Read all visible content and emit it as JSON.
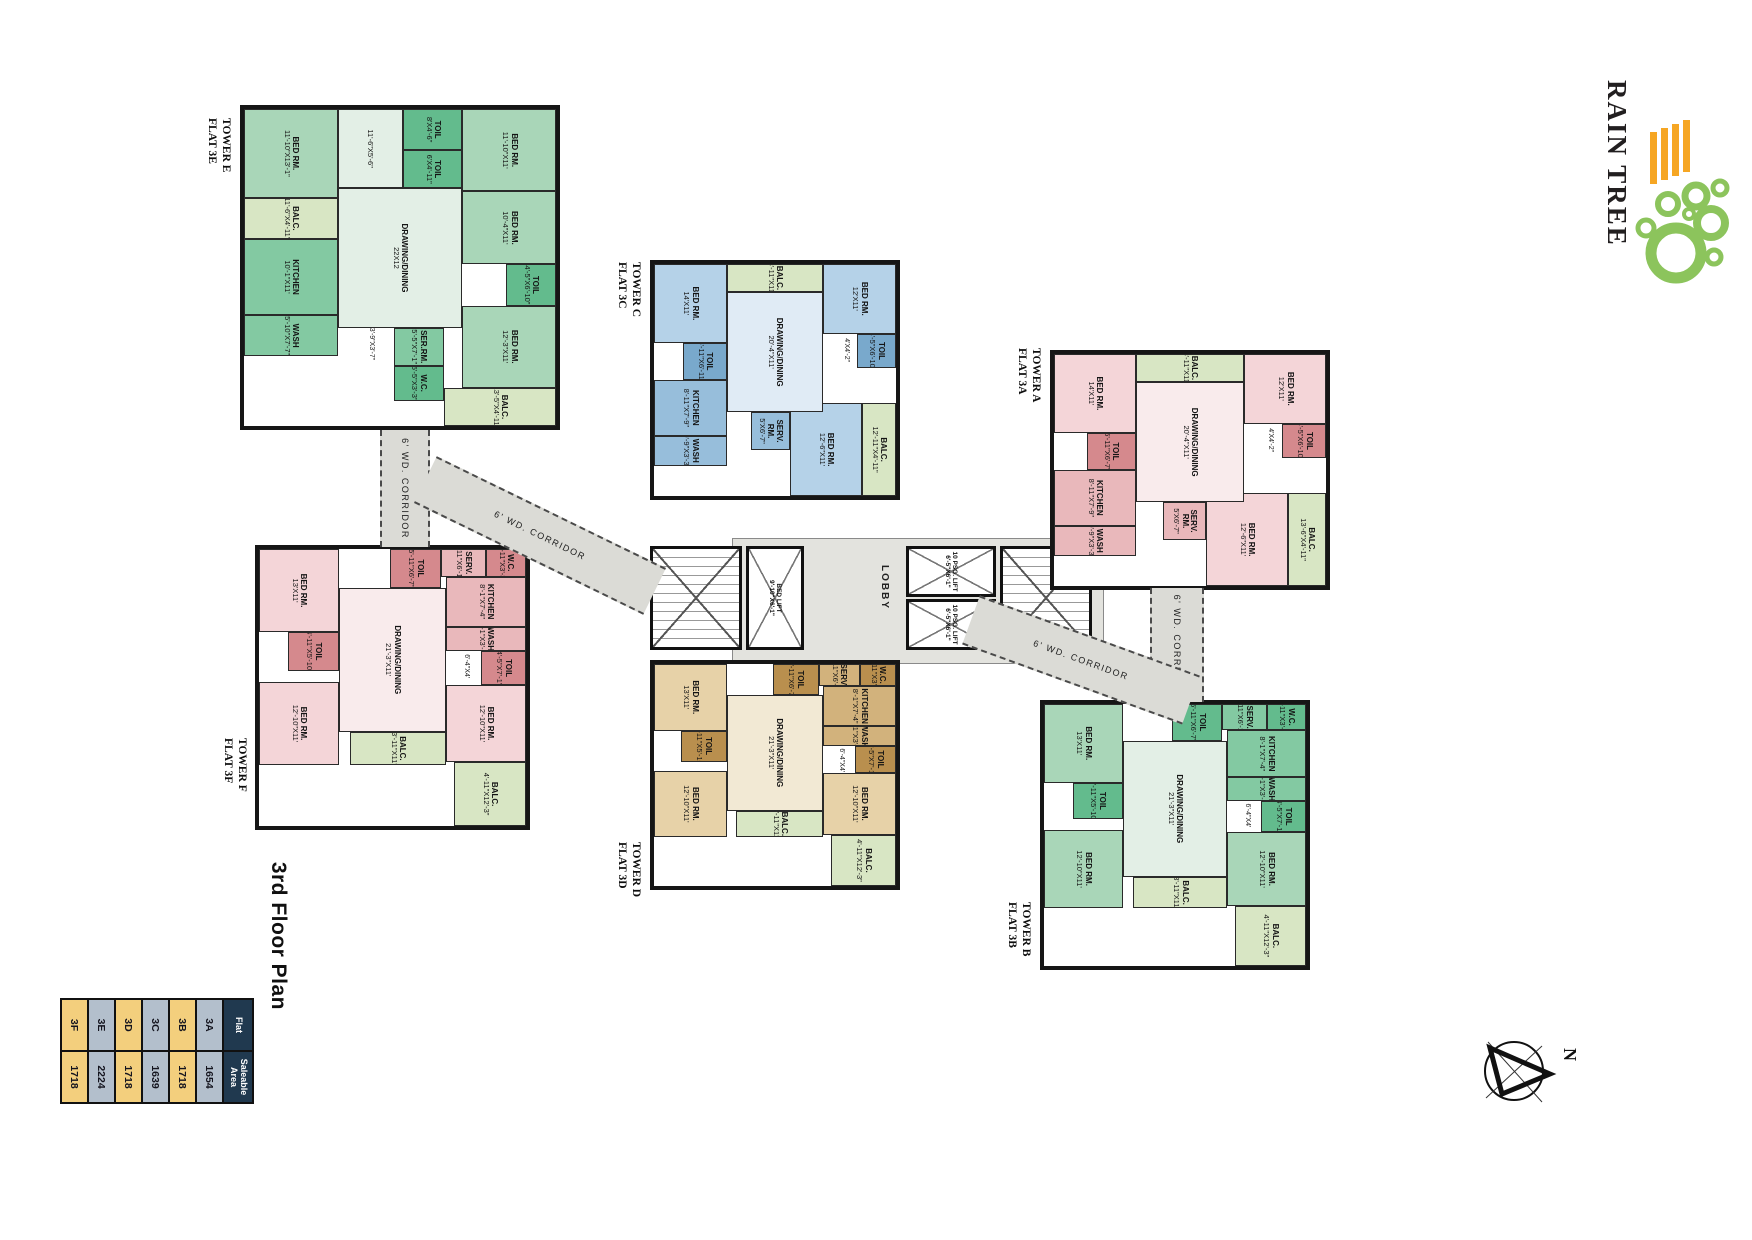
{
  "logo": {
    "name": "RAIN TREE",
    "tree_color": "#8cc45c",
    "ray_color": "#f6a623",
    "text_color": "#221f20"
  },
  "plan_title": "3rd Floor Plan",
  "compass_label": "N",
  "corridor_label": "6' WD. CORRIDOR",
  "core": {
    "lobby": "LOBBY",
    "psg_lift": "10 PSG. LIFT",
    "psg_lift_dim": "6'-5\"X6'-1\"",
    "bed_lift": "BED LIFT",
    "bed_lift_dim": "9'-10\"X6'-1\""
  },
  "area_table": {
    "headers": [
      "Flat",
      "Saleable Area"
    ],
    "rows": [
      {
        "flat": "3A",
        "area": "1654"
      },
      {
        "flat": "3B",
        "area": "1718"
      },
      {
        "flat": "3C",
        "area": "1639"
      },
      {
        "flat": "3D",
        "area": "1718"
      },
      {
        "flat": "3E",
        "area": "2224"
      },
      {
        "flat": "3F",
        "area": "1718"
      }
    ]
  },
  "towers": [
    {
      "id": "E",
      "tower_label": "TOWER E",
      "flat_label": "FLAT 3E",
      "palette": {
        "room": "#a9d6b8",
        "deep": "#63bb8d",
        "mid": "#83c9a2",
        "hall": "#e3efe6",
        "balc": "#d8e6c4"
      },
      "passages": [
        "3'-9\"X3'-7\"",
        "3'-4\"X5'-1\"",
        "4'-5\"X4'-2\"",
        "5'-10\"X5'-1\""
      ],
      "rooms": [
        {
          "name": "BED RM.",
          "dim": "11'-10\"X11'"
        },
        {
          "name": "BED RM.",
          "dim": "10'-4\"X11'"
        },
        {
          "name": "TOIL",
          "dim": "4'-5\"X6'-10\""
        },
        {
          "name": "BED RM.",
          "dim": "12'-3\"X11'"
        },
        {
          "name": "BALC.",
          "dim": "13'-5\"X4'-11\""
        },
        {
          "name": "TOIL",
          "dim": "8'X4'-6\""
        },
        {
          "name": "TOIL",
          "dim": "6'X4'-11\""
        },
        {
          "name": "",
          "dim": "11'-6\"X5'-6\""
        },
        {
          "name": "DRAWING/DINING",
          "dim": "22X12"
        },
        {
          "name": "SER.RM.",
          "dim": "5'-5\"X7'-1\""
        },
        {
          "name": "W.C.",
          "dim": "5'-5\"X3'-3\""
        },
        {
          "name": "BED RM.",
          "dim": "11'-10\"X13'-1\""
        },
        {
          "name": "BALC.",
          "dim": "11'-6\"X4'-11\""
        },
        {
          "name": "KITCHEN",
          "dim": "10'-1\"X11'"
        },
        {
          "name": "WASH",
          "dim": "5'-10\"X7'-7\""
        }
      ]
    },
    {
      "id": "C",
      "tower_label": "TOWER C",
      "flat_label": "FLAT 3C",
      "palette": {
        "room": "#b5d2e8",
        "deep": "#79a9cc",
        "mid": "#97bedb",
        "hall": "#e0ebf5",
        "balc": "#d8e6c4"
      },
      "passages": [
        "4'X4'-2\"",
        "5'-5\"X4'"
      ],
      "rooms": [
        {
          "name": "BED RM.",
          "dim": "12'X11'"
        },
        {
          "name": "TOIL",
          "dim": "4'-5\"X6'-10\""
        },
        {
          "name": "BED RM.",
          "dim": "12'-6\"X11'"
        },
        {
          "name": "BALC.",
          "dim": "12'-11\"X4'-11\""
        },
        {
          "name": "BALC.",
          "dim": "3'-11\"X11'"
        },
        {
          "name": "DRAWING/DINING",
          "dim": "20'-4\"X11'"
        },
        {
          "name": "SERV. RM.",
          "dim": "5'X6'-7\""
        },
        {
          "name": "BED RM.",
          "dim": "14'X11'"
        },
        {
          "name": "TOIL",
          "dim": "5'-11\"X6'-11\""
        },
        {
          "name": "KITCHEN",
          "dim": "8'-11\"X7'-9\""
        },
        {
          "name": "WASH",
          "dim": "9'-9\"X3'-3\""
        }
      ]
    },
    {
      "id": "A",
      "tower_label": "TOWER A",
      "flat_label": "FLAT 3A",
      "palette": {
        "room": "#f4d5d8",
        "deep": "#d5898d",
        "mid": "#e9b8bb",
        "hall": "#f9ebec",
        "balc": "#d8e6c4"
      },
      "passages": [
        "4'X4'-2\"",
        "5'-5\"X4'"
      ],
      "rooms": [
        {
          "name": "BED RM.",
          "dim": "12'X11'"
        },
        {
          "name": "TOIL",
          "dim": "4'-5\"X6'-10\""
        },
        {
          "name": "BED RM.",
          "dim": "12'-6\"X11'"
        },
        {
          "name": "BALC.",
          "dim": "13'-6\"X4'-11\""
        },
        {
          "name": "BALC.",
          "dim": "3'-11\"X11'"
        },
        {
          "name": "DRAWING/DINING",
          "dim": "20'-4\"X11'"
        },
        {
          "name": "SERV. RM.",
          "dim": "5'X6'-7\""
        },
        {
          "name": "BED RM.",
          "dim": "14'X11'"
        },
        {
          "name": "TOIL",
          "dim": "5'-11\"X6'-7\""
        },
        {
          "name": "KITCHEN",
          "dim": "8'-11\"X7'-9\""
        },
        {
          "name": "WASH",
          "dim": "9'-9\"X3'-3\""
        }
      ]
    },
    {
      "id": "F",
      "tower_label": "TOWER F",
      "flat_label": "FLAT 3F",
      "palette": {
        "room": "#f4d5d8",
        "deep": "#d5898d",
        "mid": "#e9b8bb",
        "hall": "#f9ebec",
        "balc": "#d8e6c4"
      },
      "passages": [
        "6'-4\"X4'",
        "4'-11\"X4'-2\"",
        "4'-10\"X3'-6\""
      ],
      "rooms": [
        {
          "name": "W.C.",
          "dim": "4'-11\"X3'-3\""
        },
        {
          "name": "SERV.",
          "dim": "4'-11\"X6'-11\""
        },
        {
          "name": "KITCHEN",
          "dim": "8'-1\"X7'-4\""
        },
        {
          "name": "WASH",
          "dim": "8'-1\"X3'-8\""
        },
        {
          "name": "TOIL",
          "dim": "4'-5\"X7'-1\""
        },
        {
          "name": "BED RM.",
          "dim": "12'-10\"X11'"
        },
        {
          "name": "BALC.",
          "dim": "4'-11\"X12'-3\""
        },
        {
          "name": "TOIL",
          "dim": "5'-11\"X6'-7\""
        },
        {
          "name": "DRAWING/DINING",
          "dim": "21'-3\"X11'"
        },
        {
          "name": "BALC.",
          "dim": "3'-11\"X11'"
        },
        {
          "name": "BED RM.",
          "dim": "13'X11'"
        },
        {
          "name": "TOIL",
          "dim": "4'-11\"X5'-10\""
        },
        {
          "name": "BED RM.",
          "dim": "12'-10\"X11'"
        }
      ]
    },
    {
      "id": "D",
      "tower_label": "TOWER D",
      "flat_label": "FLAT 3D",
      "palette": {
        "room": "#e7d2a8",
        "deep": "#b98f4e",
        "mid": "#d2b27c",
        "hall": "#f2e9d4",
        "balc": "#d8e6c4"
      },
      "passages": [
        "6'-4\"X4'",
        "4'-11\"X4'-2\"",
        "4'-10\"X3'-6\""
      ],
      "rooms": [
        {
          "name": "W.C.",
          "dim": "4'-11\"X3'-3\""
        },
        {
          "name": "SERV.",
          "dim": "4'-11\"X6'-11\""
        },
        {
          "name": "KITCHEN",
          "dim": "8'-1\"X7'-4\""
        },
        {
          "name": "WASH",
          "dim": "8'-1\"X3'-8\""
        },
        {
          "name": "TOIL",
          "dim": "4'-5\"X7'-1\""
        },
        {
          "name": "BED RM.",
          "dim": "12'-10\"X11'"
        },
        {
          "name": "BALC.",
          "dim": "4'-11\"X12'-3\""
        },
        {
          "name": "TOIL",
          "dim": "5'-11\"X6'-7\""
        },
        {
          "name": "DRAWING/DINING",
          "dim": "21'-3\"X11'"
        },
        {
          "name": "BALC.",
          "dim": "3'-11\"X11'"
        },
        {
          "name": "BED RM.",
          "dim": "13'X11'"
        },
        {
          "name": "TOIL",
          "dim": "4'-11\"X5'-10\""
        },
        {
          "name": "BED RM.",
          "dim": "12'-10\"X11'"
        }
      ]
    },
    {
      "id": "B",
      "tower_label": "TOWER B",
      "flat_label": "FLAT 3B",
      "palette": {
        "room": "#a9d6b8",
        "deep": "#63bb8d",
        "mid": "#83c9a2",
        "hall": "#e3efe6",
        "balc": "#d8e6c4"
      },
      "passages": [
        "6'-4\"X4'",
        "4'-11\"X4'-2\"",
        "4'-10\"X3'-6\""
      ],
      "rooms": [
        {
          "name": "W.C.",
          "dim": "4'-11\"X3'-3\""
        },
        {
          "name": "SERV.",
          "dim": "4'-11\"X6'-11\""
        },
        {
          "name": "KITCHEN",
          "dim": "8'-1\"X7'-4\""
        },
        {
          "name": "WASH",
          "dim": "8'-1\"X3'-8\""
        },
        {
          "name": "TOIL",
          "dim": "4'-5\"X7'-1\""
        },
        {
          "name": "BED RM.",
          "dim": "12'-10\"X11'"
        },
        {
          "name": "BALC.",
          "dim": "4'-11\"X12'-3\""
        },
        {
          "name": "TOIL",
          "dim": "5'-11\"X6'-7\""
        },
        {
          "name": "DRAWING/DINING",
          "dim": "21'-3\"X11'"
        },
        {
          "name": "BALC.",
          "dim": "3'-11\"X11'"
        },
        {
          "name": "BED RM.",
          "dim": "13'X11'"
        },
        {
          "name": "TOIL",
          "dim": "4'-11\"X5'-10\""
        },
        {
          "name": "BED RM.",
          "dim": "12'-10\"X11'"
        }
      ]
    }
  ]
}
